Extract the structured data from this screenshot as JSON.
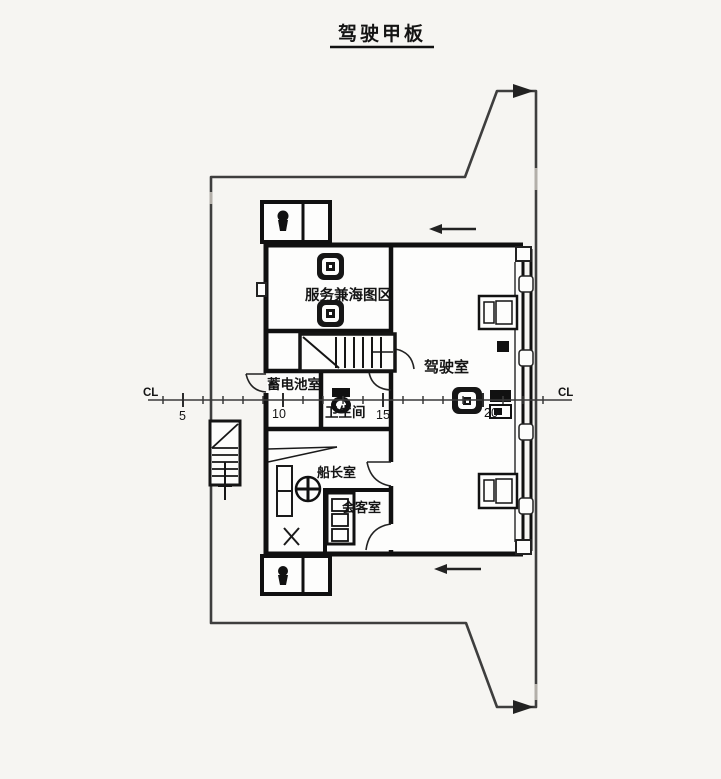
{
  "title": "驾驶甲板",
  "rooms": {
    "chart_area": "服务兼海图区",
    "wheelhouse": "驾驶室",
    "battery_room": "蓄电池室",
    "bathroom": "卫生间",
    "captain_room": "船长室",
    "meeting_room": "会客室"
  },
  "centerline": {
    "label_left": "CL",
    "label_right": "CL",
    "stations": [
      "5",
      "10",
      "15",
      "20"
    ]
  },
  "colors": {
    "background": "#f6f5f2",
    "wall": "#101010",
    "hull_outline": "#3e3e3e",
    "text": "#141414"
  }
}
